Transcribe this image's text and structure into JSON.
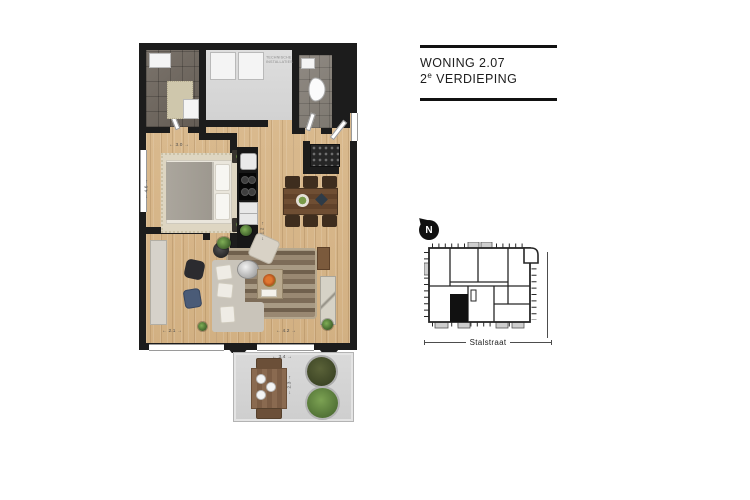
{
  "title_block": {
    "project": "WONING 2.07",
    "floor_number": "2",
    "floor_ordinal": "e",
    "floor_label": " VERDIEPING"
  },
  "floor_plan": {
    "technical_room_label": "TECHNISCHE INSTALLATIES",
    "dimensions": {
      "bedroom_width": "← 3.0 →",
      "bedroom_depth": "← 4.6 →",
      "hall_width": "← 1.2 →",
      "living_left_width": "← 2.1 →",
      "living_right_width": "← 4.2 →",
      "balcony_width": "← 3.4 →",
      "balcony_depth": "← 2.3 →"
    }
  },
  "site_map": {
    "north_label": "N",
    "street_label": "Stalstraat"
  },
  "colors": {
    "wall": "#1c1c1c",
    "wood_floor": "#d6b689",
    "balcony_floor": "#d6d6d6",
    "highlight_unit": "#111111"
  }
}
